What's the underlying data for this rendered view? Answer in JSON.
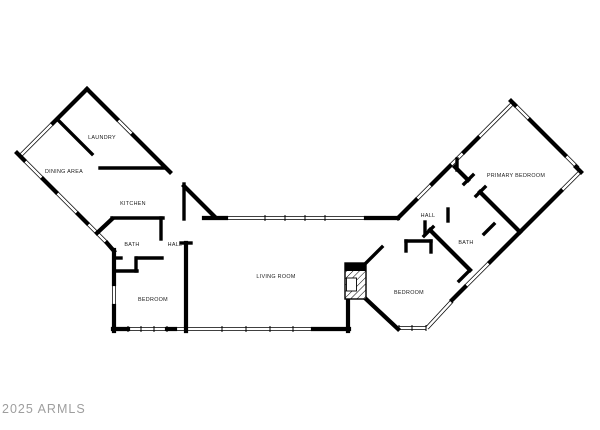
{
  "plan": {
    "background": "#ffffff",
    "wall_color": "#000000",
    "label_color": "#1a1a1a",
    "rooms": [
      {
        "id": "laundry",
        "label": "LAUNDRY"
      },
      {
        "id": "dining-area",
        "label": "DINING AREA"
      },
      {
        "id": "kitchen",
        "label": "KITCHEN"
      },
      {
        "id": "bath-left",
        "label": "BATH"
      },
      {
        "id": "hall-left",
        "label": "HALL"
      },
      {
        "id": "bedroom-left",
        "label": "BEDROOM"
      },
      {
        "id": "living-room",
        "label": "LIVING ROOM"
      },
      {
        "id": "hall-right",
        "label": "HALL"
      },
      {
        "id": "bath-right",
        "label": "BATH"
      },
      {
        "id": "primary-bedroom",
        "label": "PRIMARY BEDROOM"
      },
      {
        "id": "bedroom-right",
        "label": "BEDROOM"
      }
    ]
  },
  "watermark": {
    "text": "2025 ARMLS",
    "color": "#9e9e9e"
  }
}
